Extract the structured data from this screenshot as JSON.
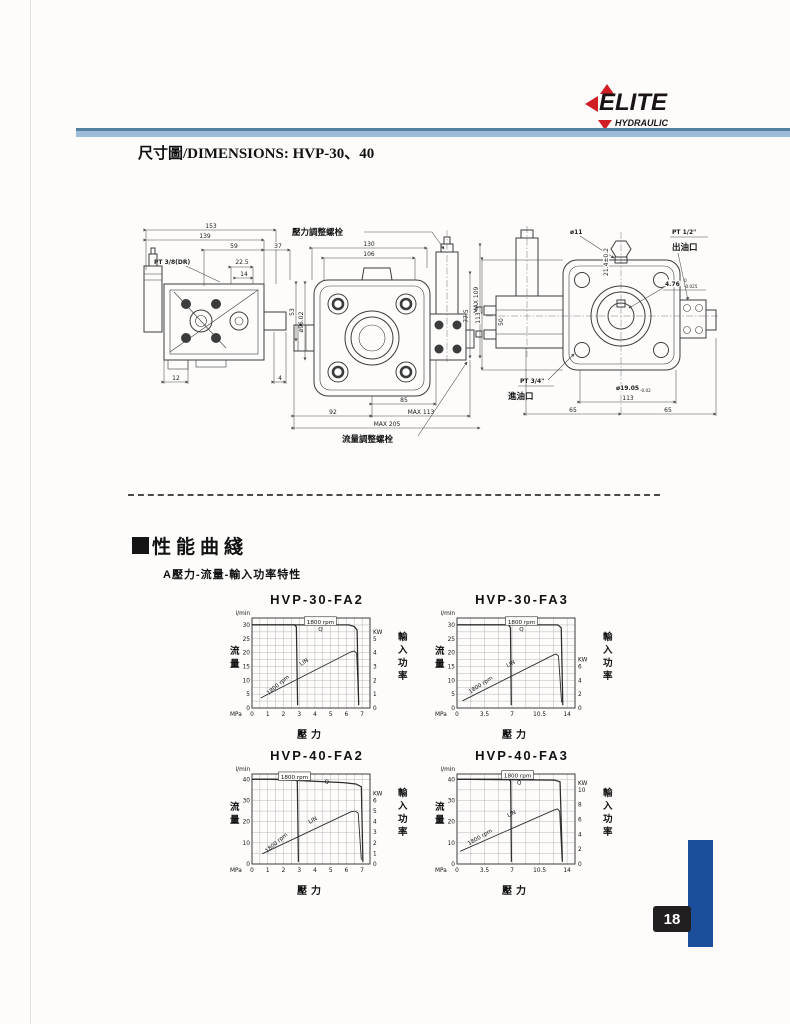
{
  "header": {
    "logo": {
      "brand": "ELITE",
      "sub": "HYDRAULIC"
    },
    "title": "尺寸圖/DIMENSIONS:  HVP-30、40"
  },
  "section": {
    "heading": "性能曲綫",
    "subtitle": "A壓力-流量-輸入功率特性"
  },
  "drawings": {
    "d1": {
      "d153": "153",
      "d139": "139",
      "d59": "59",
      "d37": "37",
      "pt": "PT 3/8(DR)",
      "d225": "22.5",
      "d14": "14",
      "d53": "53",
      "shaft_dia": "ø96.02",
      "d12": "12",
      "d4": "4"
    },
    "d2": {
      "top_label": "壓力調整螺栓",
      "bottom_label": "流量調整螺栓",
      "d130": "130",
      "d106": "106",
      "max109": "MAX 109",
      "d775": "77.5",
      "d85": "85",
      "d92": "92",
      "max113": "MAX 113",
      "max205": "MAX 205"
    },
    "d3": {
      "phi11": "ø11",
      "t214": "21.4±0.2",
      "pt12": "PT 1/2\"",
      "outlet": "出油口",
      "t476": "4.76",
      "t476_tol_hi": "0",
      "t476_tol_lo": "-0.025",
      "phi1905": "ø19.05",
      "phi1905_tol": "-0.02",
      "pt34": "PT 3/4\"",
      "inlet": "進油口",
      "d113v": "113",
      "d50": "50",
      "d113": "113",
      "d65a": "65",
      "d65b": "65"
    }
  },
  "chart_data": [
    {
      "type": "line",
      "title": "HVP-30-FA2",
      "x": {
        "label": "壓力",
        "unit": "MPa",
        "ticks": [
          0,
          1,
          2,
          3,
          4,
          5,
          6,
          7
        ],
        "plot_max": 7.5,
        "grid_step": 0.5
      },
      "y_left": {
        "label": "流量",
        "unit": "l/min",
        "ticks": [
          0,
          5,
          10,
          15,
          20,
          25,
          30
        ],
        "plot_max": 32.5,
        "grid_step": 2.5
      },
      "y_right": {
        "label": "輸入功率",
        "unit": "KW",
        "ticks": [
          0,
          1,
          2,
          3,
          4,
          5
        ],
        "lmin_per_kw": 5
      },
      "series": [
        {
          "name": "flow-at-min-pressure-setting",
          "points": [
            [
              0,
              30
            ],
            [
              2.7,
              30
            ],
            [
              2.82,
              29.3
            ],
            [
              2.9,
              1
            ]
          ]
        },
        {
          "name": "flow-at-max-pressure-setting",
          "points": [
            [
              0,
              30
            ],
            [
              6.15,
              30
            ],
            [
              6.5,
              29.4
            ],
            [
              6.68,
              28.2
            ],
            [
              6.78,
              1
            ]
          ]
        },
        {
          "name": "input-power-1800rpm",
          "points": [
            [
              0.55,
              3.6
            ],
            [
              6.3,
              20.3
            ],
            [
              6.5,
              20.6
            ],
            [
              6.65,
              19.8
            ],
            [
              6.78,
              2
            ]
          ]
        }
      ],
      "annotations": [
        {
          "text": "1800 rpm",
          "x": 4.35,
          "y": 30.6,
          "boxed": true
        },
        {
          "text": "Q",
          "x": 4.35,
          "y": 27.9
        },
        {
          "text": "LIN",
          "x": 3.35,
          "y": 16.2,
          "rotate": -35
        },
        {
          "text": "1800 rpm",
          "x": 1.7,
          "y": 8.0,
          "rotate": -40
        }
      ]
    },
    {
      "type": "line",
      "title": "HVP-30-FA3",
      "x": {
        "label": "壓力",
        "unit": "MPa",
        "ticks": [
          0,
          3.5,
          7,
          10.5,
          14
        ],
        "plot_max": 15,
        "grid_step": 1.75
      },
      "y_left": {
        "label": "流量",
        "unit": "l/min",
        "ticks": [
          0,
          5,
          10,
          15,
          20,
          25,
          30
        ],
        "plot_max": 32.5,
        "grid_step": 2.5
      },
      "y_right": {
        "label": "輸入功率",
        "unit": "KW",
        "ticks": [
          0,
          2,
          4,
          6
        ],
        "lmin_per_kw": 2.5
      },
      "series": [
        {
          "name": "flow-at-min-pressure-setting",
          "points": [
            [
              0,
              30
            ],
            [
              6.55,
              30
            ],
            [
              6.8,
              29
            ],
            [
              6.9,
              1
            ]
          ]
        },
        {
          "name": "flow-at-max-pressure-setting",
          "points": [
            [
              0,
              30
            ],
            [
              12.8,
              30
            ],
            [
              13.25,
              29
            ],
            [
              13.45,
              1
            ]
          ]
        },
        {
          "name": "input-power-1800rpm",
          "points": [
            [
              0.7,
              2.6
            ],
            [
              12.3,
              19.2
            ],
            [
              12.6,
              19.5
            ],
            [
              12.9,
              18.8
            ],
            [
              13.3,
              2
            ]
          ]
        }
      ],
      "annotations": [
        {
          "text": "1800 rpm",
          "x": 8.2,
          "y": 30.6,
          "boxed": true
        },
        {
          "text": "Q",
          "x": 8.2,
          "y": 27.9
        },
        {
          "text": "LIN",
          "x": 6.9,
          "y": 15.6,
          "rotate": -28
        },
        {
          "text": "1800 rpm",
          "x": 3.1,
          "y": 8.0,
          "rotate": -33
        }
      ]
    },
    {
      "type": "line",
      "title": "HVP-40-FA2",
      "x": {
        "label": "壓力",
        "unit": "MPa",
        "ticks": [
          0,
          1,
          2,
          3,
          4,
          5,
          6,
          7
        ],
        "plot_max": 7.5,
        "grid_step": 0.5
      },
      "y_left": {
        "label": "流量",
        "unit": "l/min",
        "ticks": [
          0,
          10,
          20,
          30,
          40
        ],
        "plot_max": 42.5,
        "grid_step": 5
      },
      "y_right": {
        "label": "輸入功率",
        "unit": "KW",
        "ticks": [
          0,
          1,
          2,
          3,
          4,
          5,
          6
        ],
        "lmin_per_kw": 5
      },
      "series": [
        {
          "name": "flow-at-min-pressure-setting",
          "points": [
            [
              0,
              40
            ],
            [
              2.75,
              40
            ],
            [
              2.88,
              39
            ],
            [
              2.95,
              1
            ]
          ]
        },
        {
          "name": "flow-at-max-pressure-setting",
          "points": [
            [
              0,
              40
            ],
            [
              1.2,
              40
            ],
            [
              5.8,
              38.4
            ],
            [
              6.6,
              37.8
            ],
            [
              6.95,
              36.5
            ],
            [
              7.05,
              1
            ]
          ]
        },
        {
          "name": "input-power-1800rpm",
          "points": [
            [
              0.65,
              4.8
            ],
            [
              6.3,
              24.7
            ],
            [
              6.55,
              25
            ],
            [
              6.75,
              24
            ],
            [
              6.95,
              2
            ]
          ]
        }
      ],
      "annotations": [
        {
          "text": "1800 rpm",
          "x": 2.7,
          "y": 40.4,
          "boxed": true
        },
        {
          "text": "Q",
          "x": 4.75,
          "y": 38.2
        },
        {
          "text": "LIN",
          "x": 3.9,
          "y": 20.2,
          "rotate": -30
        },
        {
          "text": "1800 rpm",
          "x": 1.6,
          "y": 9.6,
          "rotate": -40
        }
      ]
    },
    {
      "type": "line",
      "title": "HVP-40-FA3",
      "x": {
        "label": "壓力",
        "unit": "MPa",
        "ticks": [
          0,
          3.5,
          7,
          10.5,
          14
        ],
        "plot_max": 15,
        "grid_step": 1.75
      },
      "y_left": {
        "label": "流量",
        "unit": "l/min",
        "ticks": [
          0,
          10,
          20,
          30,
          40
        ],
        "plot_max": 42.5,
        "grid_step": 5
      },
      "y_right": {
        "label": "輸入功率",
        "unit": "KW",
        "ticks": [
          0,
          2,
          4,
          6,
          8,
          10
        ],
        "lmin_per_kw": 3.5
      },
      "series": [
        {
          "name": "flow-at-min-pressure-setting",
          "points": [
            [
              0,
              40
            ],
            [
              6.6,
              40
            ],
            [
              6.82,
              39
            ],
            [
              6.92,
              1
            ]
          ]
        },
        {
          "name": "flow-at-max-pressure-setting",
          "points": [
            [
              0,
              40
            ],
            [
              12.4,
              39.6
            ],
            [
              13.1,
              38.8
            ],
            [
              13.4,
              1
            ]
          ]
        },
        {
          "name": "input-power-1800rpm",
          "points": [
            [
              0.4,
              6
            ],
            [
              12.4,
              25.6
            ],
            [
              12.75,
              26
            ],
            [
              13.05,
              25
            ],
            [
              13.35,
              2
            ]
          ]
        }
      ],
      "annotations": [
        {
          "text": "1800 rpm",
          "x": 7.7,
          "y": 41.0,
          "boxed": true
        },
        {
          "text": "Q",
          "x": 7.9,
          "y": 37.8
        },
        {
          "text": "LIN",
          "x": 7.0,
          "y": 23.2,
          "rotate": -25
        },
        {
          "text": "1800 rpm",
          "x": 3.0,
          "y": 12.2,
          "rotate": -30
        }
      ]
    }
  ],
  "footer": {
    "page_number": "18"
  },
  "colors": {
    "logo_red": "#cf1f24",
    "header_bar_blue": "#9cbdd8",
    "side_bar_blue": "#1b4e9b",
    "badge_black": "#231f20",
    "ink": "#3c3c3c"
  }
}
